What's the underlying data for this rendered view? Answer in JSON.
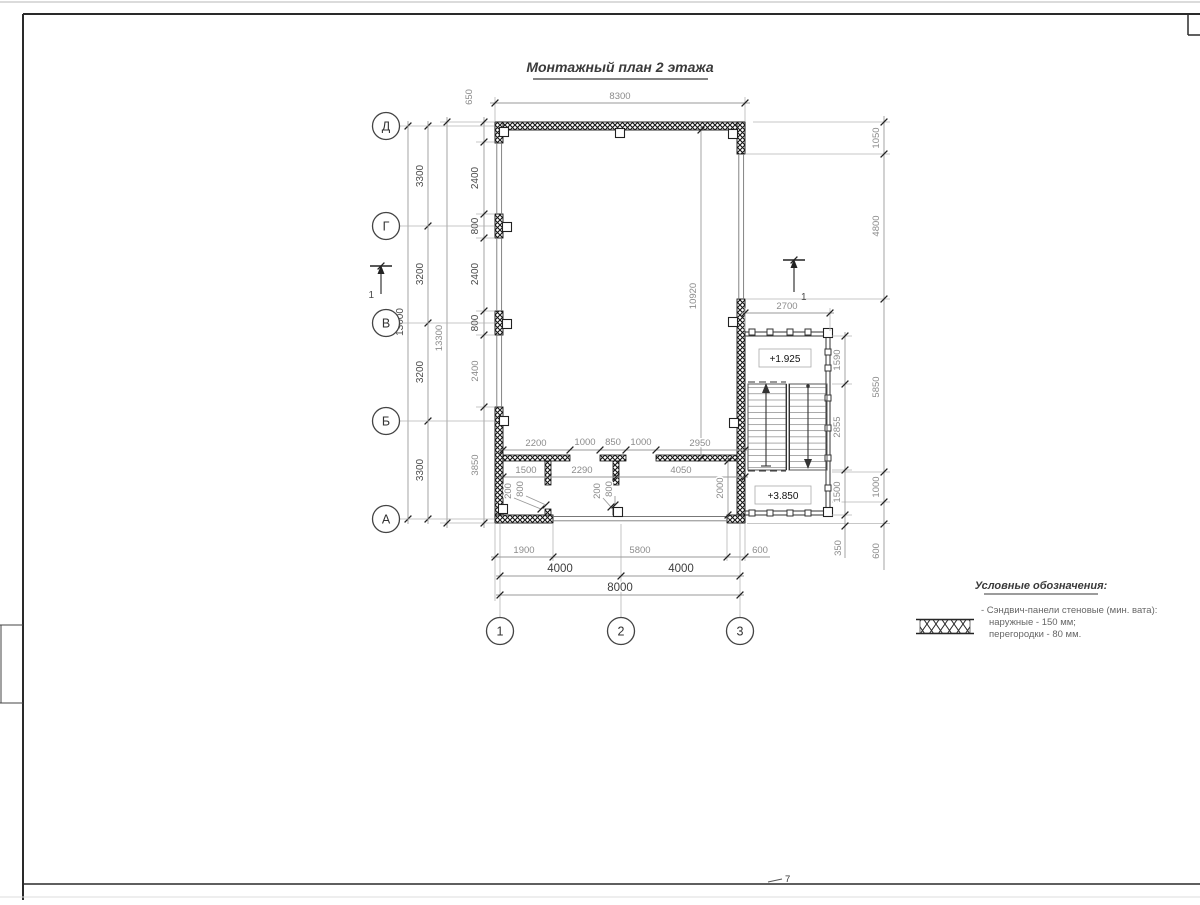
{
  "title": "Монтажный план 2 этажа",
  "page_mark": "7",
  "section_marker": "1",
  "axes": {
    "rows": [
      "Д",
      "Г",
      "В",
      "Б",
      "А"
    ],
    "cols": [
      "1",
      "2",
      "3"
    ]
  },
  "elevations": {
    "upper": "+1.925",
    "lower": "+3.850"
  },
  "dims": {
    "top_width": "8300",
    "top_corner": "650",
    "axis_total": "13000",
    "outer_total": "13300",
    "axis_spans": [
      "3300",
      "3200",
      "3200",
      "3300"
    ],
    "left_wall_chain": [
      "2400",
      "800",
      "2400",
      "800",
      "2400",
      "3850"
    ],
    "interior_height": "10920",
    "room_depth": "2000",
    "partition_top_row": [
      "2200",
      "1000",
      "850",
      "1000",
      "2950"
    ],
    "partition_bottom_row": [
      "1500",
      "2290",
      "4050"
    ],
    "door_marks": [
      "200",
      "800",
      "200",
      "800"
    ],
    "bottom_segments": [
      "1900",
      "5800",
      "600"
    ],
    "bottom_spans": [
      "4000",
      "4000"
    ],
    "bottom_total": "8000",
    "stair_width": "2700",
    "stair_chain": [
      "1590",
      "2855",
      "1500",
      "350"
    ],
    "right_chain": [
      "1050",
      "4800",
      "5850",
      "1000",
      "600"
    ]
  },
  "legend": {
    "title": "Условные обозначения:",
    "line1": "- Сэндвич-панели стеновые (мин. вата):",
    "line2": "наружные - 150 мм;",
    "line3": "перегородки - 80 мм."
  }
}
